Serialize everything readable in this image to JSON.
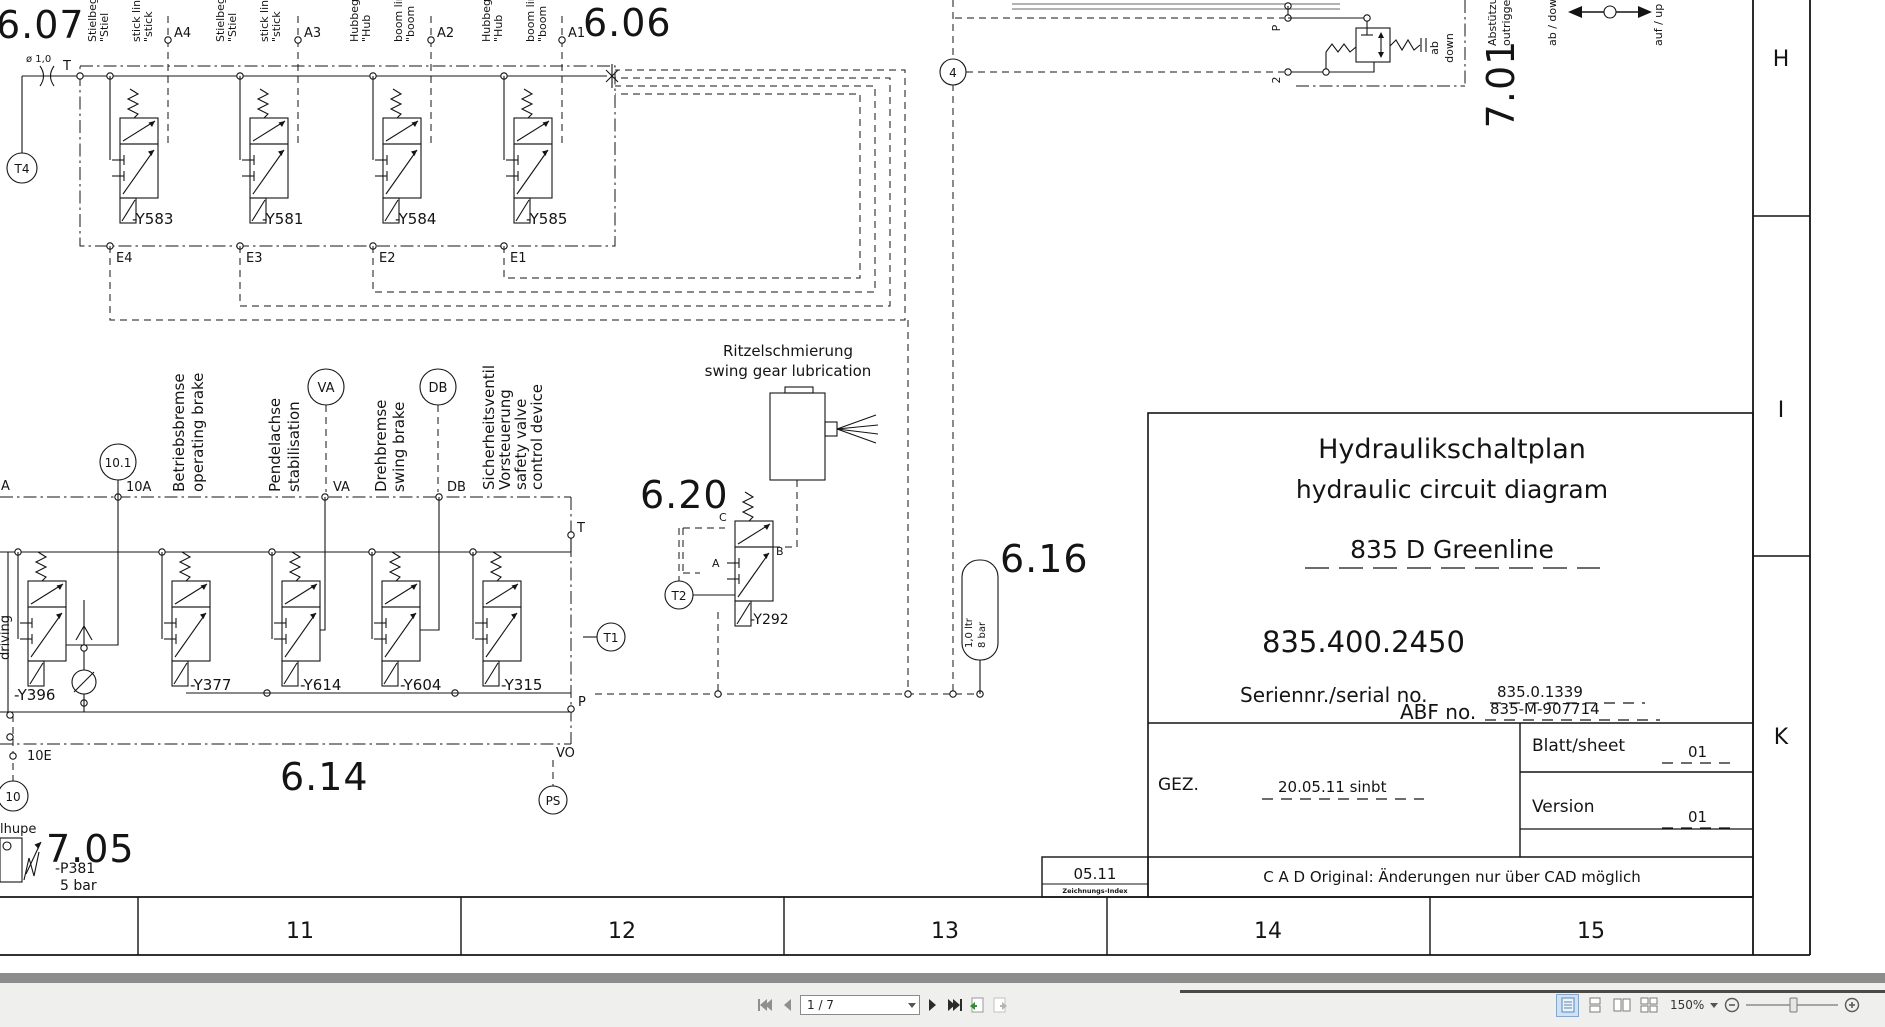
{
  "schematic": {
    "sections": {
      "s607": "6.07",
      "s606": "6.06",
      "s614": "6.14",
      "s620": "6.20",
      "s616": "6.16",
      "s705": "7.05",
      "s701": "7.01"
    },
    "top_group": {
      "t4": "T4",
      "t": "T",
      "orifice": "ø 1,0",
      "groups": [
        {
          "lines": [
            "Stielbegr",
            "\"Stiel",
            "stick lin",
            "\"stick"
          ]
        },
        {
          "lines": [
            "Stielbegr",
            "\"Stiel",
            "stick lin",
            "\"stick"
          ]
        },
        {
          "lines": [
            "Hubbegr",
            "\"Hub",
            "boom lin",
            "\"boom"
          ]
        },
        {
          "lines": [
            "Hubbegr",
            "\"Hub",
            "boom lin",
            "\"boom"
          ]
        }
      ],
      "a_ports": [
        "A4",
        "A3",
        "A2",
        "A1"
      ],
      "e_ports": [
        "E4",
        "E3",
        "E2",
        "E1"
      ],
      "valves": [
        "-Y583",
        "-Y581",
        "-Y584",
        "-Y585"
      ]
    },
    "left_fragment": {
      "lines": [
        "Fahren,",
        "driving"
      ]
    },
    "mid_group": {
      "labels": [
        [
          "Betriebsbremse",
          "operating brake"
        ],
        [
          "Pendelachse",
          "stabilisation"
        ],
        [
          "Drehbremse",
          "swing brake"
        ],
        [
          "Sicherheitsventil",
          "Vorsteuerung",
          "safety valve",
          "control device"
        ]
      ],
      "port_a": "A",
      "c101": "10.1",
      "p10a": "10A",
      "va": "VA",
      "db": "DB",
      "t": "T",
      "t1": "T1",
      "p": "P",
      "vo": "VO",
      "ps": "PS",
      "e10": "10E",
      "c10": "10",
      "valves": [
        "-Y396",
        "-Y377",
        "-Y614",
        "-Y604",
        "-Y315"
      ]
    },
    "lubrication": {
      "de": "Ritzelschmierung",
      "en": "swing gear lubrication",
      "valve": "-Y292",
      "c": "C",
      "b": "B",
      "a": "A",
      "t2": "T2"
    },
    "accumulator": {
      "c4": "4",
      "volume": "1,0 ltr",
      "pressure": "8 bar"
    },
    "horn": {
      "fragment": "lhupe",
      "id": "-P381",
      "pressure": "5 bar"
    },
    "outrigger": {
      "p": "P",
      "two": "2",
      "ab": "ab",
      "down": "down",
      "de": "Abstützung",
      "en": "outrigger",
      "left_arrow": "ab / down",
      "right_arrow": "auf / up"
    },
    "ruler": [
      "11",
      "12",
      "13",
      "14",
      "15"
    ],
    "rows": [
      "H",
      "I",
      "K"
    ]
  },
  "title_block": {
    "title_de": "Hydraulikschaltplan",
    "title_en": "hydraulic circuit diagram",
    "model": "835 D Greenline",
    "part_no": "835.400.2450",
    "serial_label": "Seriennr./serial  no.",
    "serial_value": "835.0.1339",
    "abf_label": "ABF  no.",
    "abf_value": "835-M-907714",
    "gez_label": "GEZ.",
    "gez_value": "20.05.11 sinbt",
    "sheet_label": "Blatt/sheet",
    "sheet_value": "01",
    "version_label": "Version",
    "version_value": "01",
    "index_value": "05.11",
    "index_label": "Zeichnungs-Index",
    "cad_note": "C A D Original: Änderungen nur über CAD möglich"
  },
  "toolbar": {
    "page_field": "1 / 7",
    "zoom_level": "150%"
  }
}
